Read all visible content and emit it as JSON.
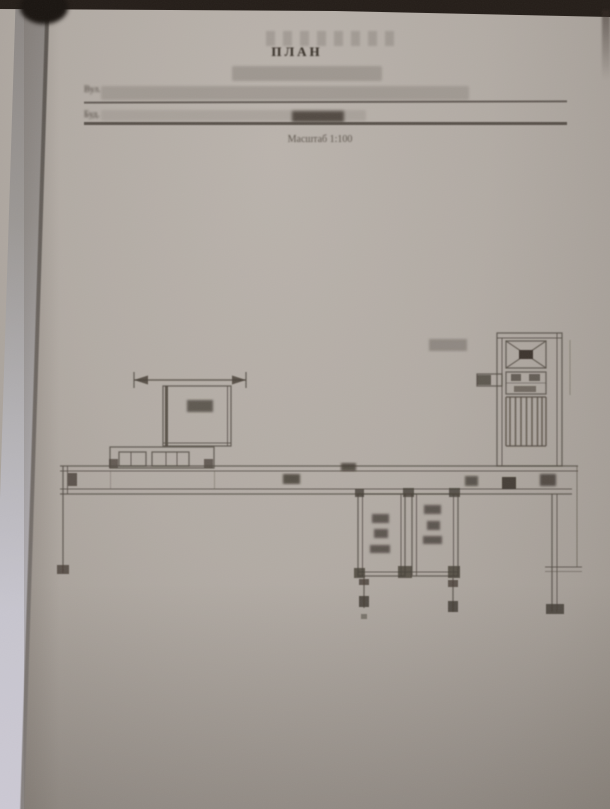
{
  "document": {
    "title": "ПЛАН",
    "field1_label": "Вул.",
    "field2_label": "Буд.",
    "scale_note": "Масштаб 1:100"
  },
  "drawing": {
    "kind": "floor plan",
    "elements": [
      "corridor",
      "left room with porch",
      "two lower rooms",
      "elevator shaft",
      "stair flight",
      "dimension lines with arrowheads"
    ]
  },
  "colors": {
    "paper": "#b1aaa3",
    "ink": "#564e46",
    "ink_dark": "#3b342d",
    "top_band": "#241d18",
    "left_edge_light": "#c7c5ce",
    "redaction_bar": "#9d968f"
  }
}
